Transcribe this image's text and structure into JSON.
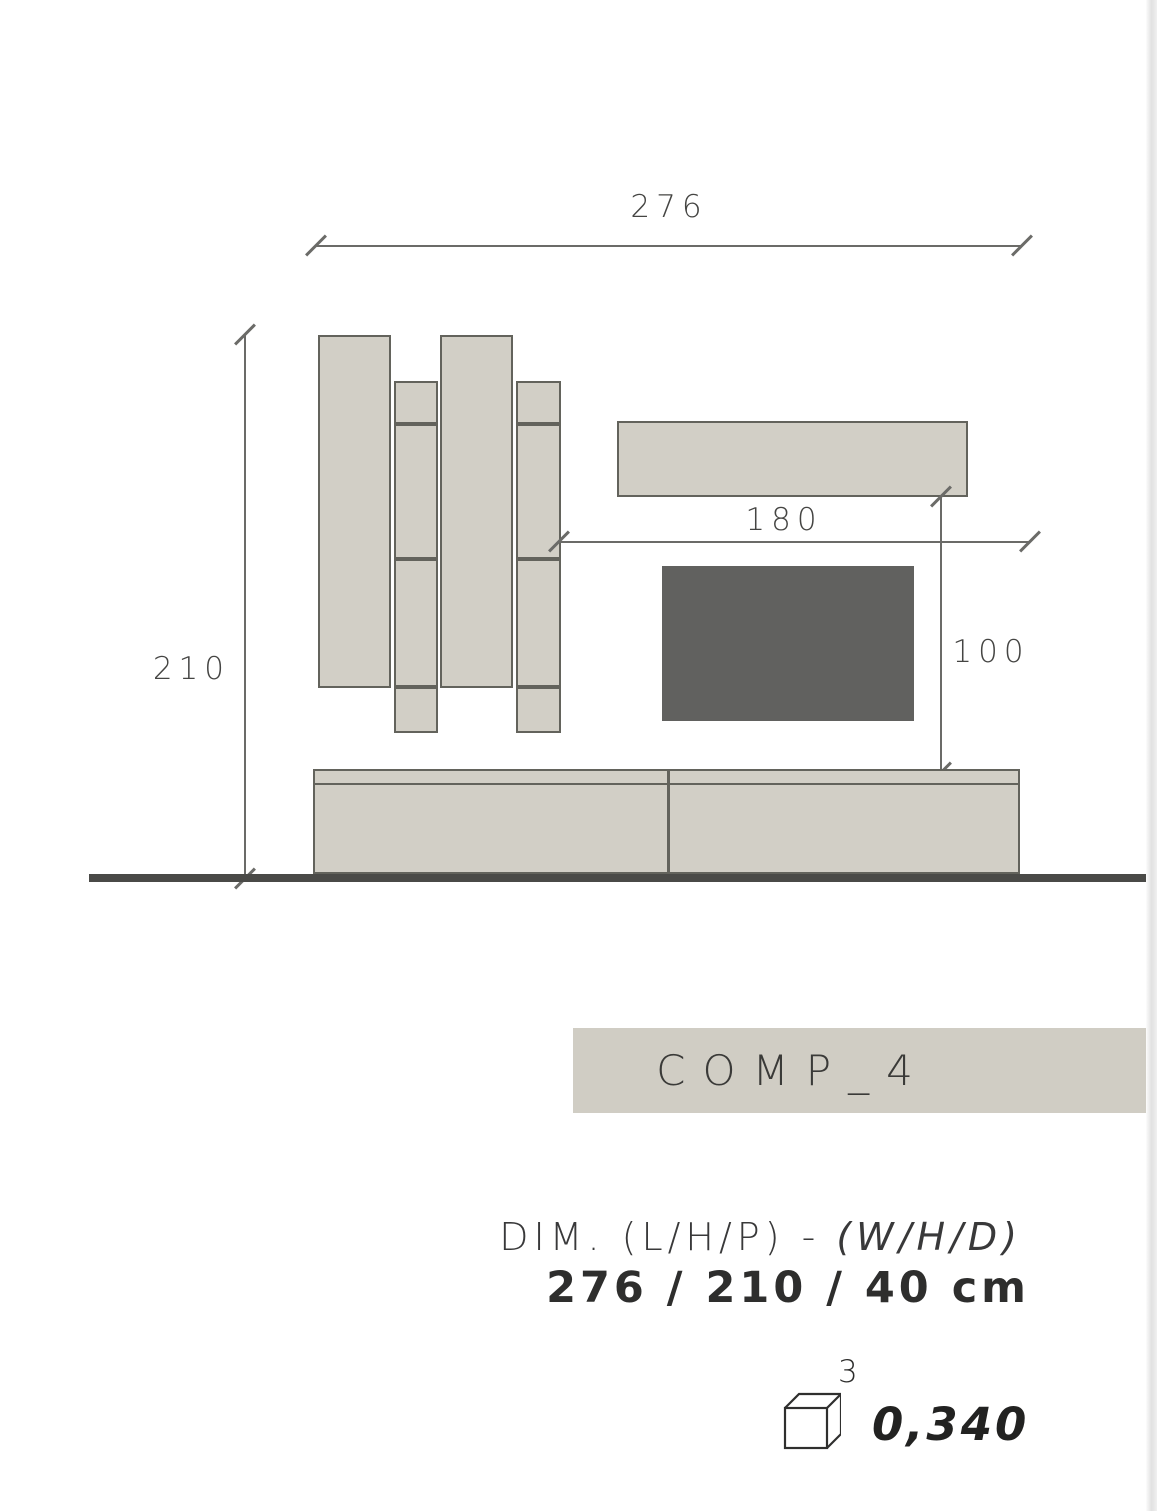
{
  "colors": {
    "page_bg": "#ffffff",
    "panel_fill": "#d2cfc6",
    "panel_border": "#63635c",
    "tv_fill": "#61615f",
    "floor_line": "#4a4a47",
    "dim_line": "#6b6b68",
    "dim_text": "#454543",
    "banner_fill": "#d0cdc4",
    "banner_text": "#3a3a38",
    "spec_text": "#39393a"
  },
  "drawing": {
    "dim_width": "276",
    "dim_height": "210",
    "dim_shelf_width": "180",
    "dim_tv_gap": "100"
  },
  "banner": {
    "title": "COMP_4"
  },
  "specs": {
    "caption_main": "DIM. (L/H/P) -",
    "caption_alt": "(W/H/D)",
    "values": "276 / 210 / 40 cm",
    "volume_icon": "cube-icon",
    "volume_exponent": "3",
    "volume_value": "0,340"
  }
}
